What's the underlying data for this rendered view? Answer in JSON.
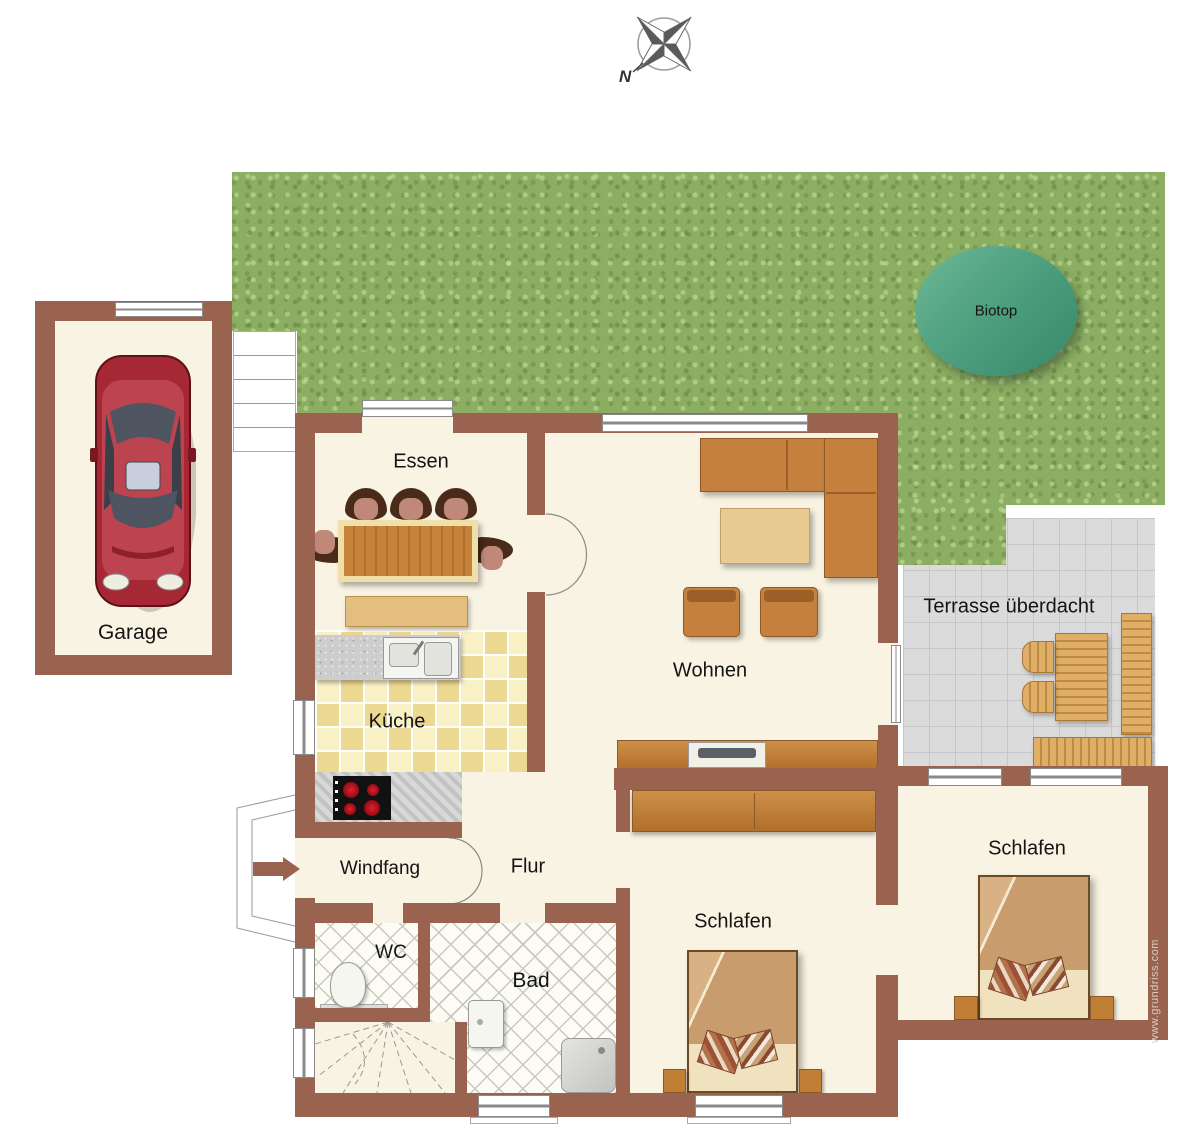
{
  "compass": {
    "north_label": "N"
  },
  "watermark": "www.grundriss.com",
  "rooms": {
    "garage": {
      "label": "Garage"
    },
    "essen": {
      "label": "Essen"
    },
    "kueche": {
      "label": "Küche"
    },
    "wohnen": {
      "label": "Wohnen"
    },
    "terrasse": {
      "label": "Terrasse überdacht"
    },
    "windfang": {
      "label": "Windfang"
    },
    "flur": {
      "label": "Flur"
    },
    "wc": {
      "label": "WC"
    },
    "bad": {
      "label": "Bad"
    },
    "schlafen_mitte": {
      "label": "Schlafen"
    },
    "schlafen_rechts": {
      "label": "Schlafen"
    },
    "biotop": {
      "label": "Biotop"
    }
  },
  "colors": {
    "wall": "#9A6350",
    "floor": "#F8F3E2",
    "garden": "#8BAE62",
    "terrace": "#DBDBDB",
    "kitchen_tile": "#F7F0C4",
    "wood": "#C68136",
    "sofa": "#C5803E",
    "biotop": "#3E9678",
    "car": "#A62834"
  }
}
